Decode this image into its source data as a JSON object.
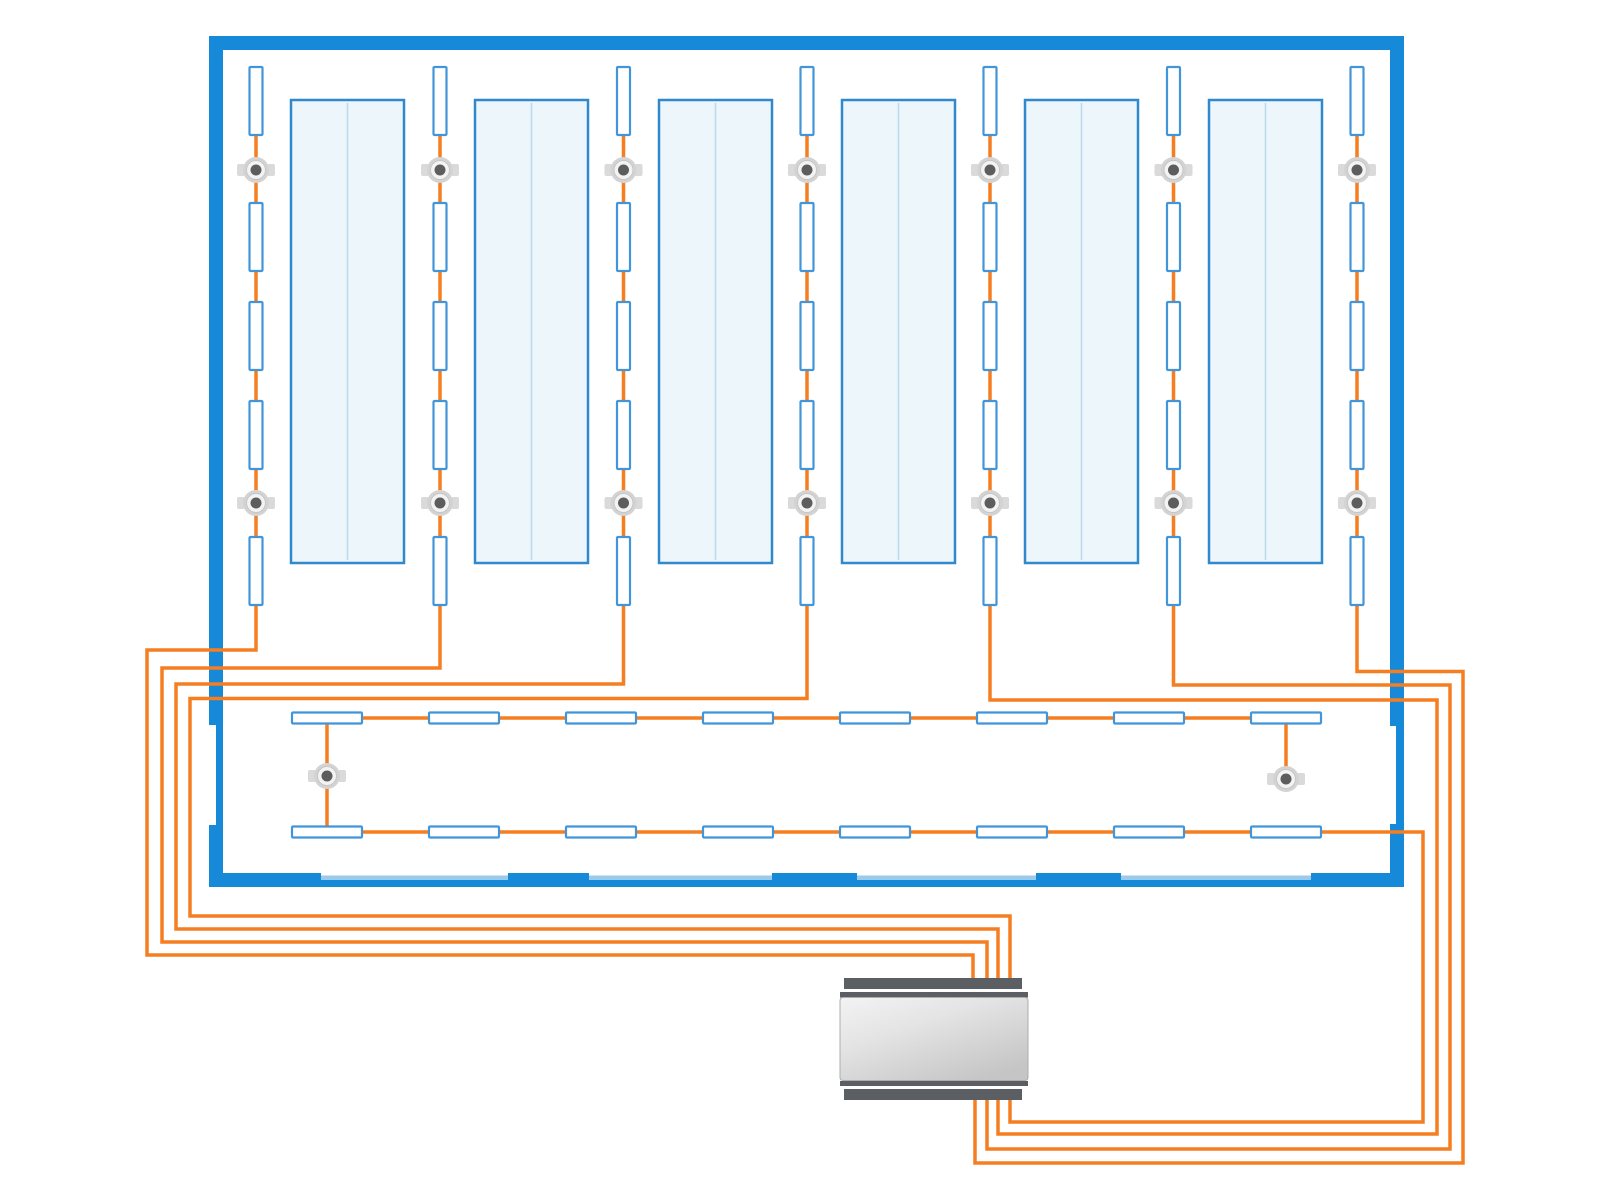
{
  "canvas": {
    "width": 1600,
    "height": 1200,
    "background": "#ffffff"
  },
  "palette": {
    "wall": "#1789d9",
    "wall_light": "#9ccaeb",
    "panel_border": "#3088cd",
    "panel_fill": "#edf6fb",
    "panel_line": "#bcd9ec",
    "fixture_border": "#4295d9",
    "fixture_fill": "#ffffff",
    "wire": "#f57e20",
    "sensor_tab": "#dadada",
    "sensor_ring": "#d3d3d3",
    "sensor_mid": "#f3f3f3",
    "sensor_dot": "#5d5d5d",
    "device_bar": "#5b5f63",
    "device_edge": "#adadad"
  },
  "room": {
    "walls": [
      {
        "x": 209,
        "y": 36,
        "w": 1195,
        "h": 14
      },
      {
        "x": 209,
        "y": 36,
        "w": 14,
        "h": 689
      },
      {
        "x": 216,
        "y": 725,
        "w": 7,
        "h": 100
      },
      {
        "x": 209,
        "y": 825,
        "w": 14,
        "h": 62
      },
      {
        "x": 1390,
        "y": 36,
        "w": 14,
        "h": 690
      },
      {
        "x": 1396,
        "y": 726,
        "w": 8,
        "h": 98
      },
      {
        "x": 1390,
        "y": 824,
        "w": 14,
        "h": 63
      },
      {
        "x": 209,
        "y": 880,
        "w": 1195,
        "h": 7
      }
    ],
    "bottom_glass": {
      "x": 223,
      "y": 875.5,
      "w": 1167,
      "h": 4.5
    },
    "bottom_blocks": {
      "y": 873,
      "h": 14,
      "xw": [
        [
          223,
          98
        ],
        [
          508,
          81
        ],
        [
          772,
          85
        ],
        [
          1036,
          85
        ],
        [
          1311,
          93
        ]
      ]
    }
  },
  "panels": {
    "y": 100,
    "w": 113,
    "h": 463,
    "lefts": [
      291,
      475,
      659,
      842,
      1025,
      1209
    ]
  },
  "columns": {
    "centers": [
      256,
      440,
      623.5,
      807,
      990,
      1173.5,
      1357
    ],
    "fixture": {
      "w": 13,
      "h": 68
    },
    "fixture_tops": [
      67,
      203,
      302,
      401,
      537
    ],
    "sensor_ys": [
      170,
      503
    ]
  },
  "corridor": {
    "fixture": {
      "w": 70,
      "h": 11
    },
    "centers": [
      327,
      464,
      601,
      738,
      875,
      1012,
      1149,
      1286
    ],
    "row_tops": [
      712.5,
      826.5
    ],
    "sensors": [
      [
        327,
        776
      ],
      [
        1286,
        779
      ]
    ]
  },
  "wires": [
    {
      "name": "circuit-column-1",
      "points": [
        [
          256,
          120
        ],
        [
          256,
          650
        ],
        [
          147,
          650
        ],
        [
          147,
          955
        ],
        [
          973,
          955
        ],
        [
          973,
          985
        ]
      ]
    },
    {
      "name": "circuit-column-2",
      "points": [
        [
          440,
          120
        ],
        [
          440,
          668
        ],
        [
          162,
          668
        ],
        [
          162,
          942
        ],
        [
          987,
          942
        ],
        [
          987,
          985
        ]
      ]
    },
    {
      "name": "circuit-column-3",
      "points": [
        [
          623.5,
          120
        ],
        [
          623.5,
          684
        ],
        [
          176,
          684
        ],
        [
          176,
          929
        ],
        [
          998,
          929
        ],
        [
          998,
          985
        ]
      ]
    },
    {
      "name": "circuit-column-4",
      "points": [
        [
          807,
          120
        ],
        [
          807,
          698.5
        ],
        [
          190,
          698.5
        ],
        [
          190,
          916
        ],
        [
          1010,
          916
        ],
        [
          1010,
          985
        ]
      ]
    },
    {
      "name": "circuit-column-5",
      "points": [
        [
          990,
          120
        ],
        [
          990,
          700
        ],
        [
          1437,
          700
        ],
        [
          1437,
          1134
        ],
        [
          998,
          1134
        ],
        [
          998,
          1095
        ]
      ]
    },
    {
      "name": "circuit-column-6",
      "points": [
        [
          1173.5,
          120
        ],
        [
          1173.5,
          685
        ],
        [
          1450,
          685
        ],
        [
          1450,
          1149
        ],
        [
          987,
          1149
        ],
        [
          987,
          1095
        ]
      ]
    },
    {
      "name": "circuit-column-7",
      "points": [
        [
          1357,
          120
        ],
        [
          1357,
          671.5
        ],
        [
          1463,
          671.5
        ],
        [
          1463,
          1163
        ],
        [
          975,
          1163
        ],
        [
          975,
          1095
        ]
      ]
    },
    {
      "name": "corridor-top-run",
      "points": [
        [
          327,
          718
        ],
        [
          1286,
          718
        ]
      ]
    },
    {
      "name": "corridor-left-link",
      "points": [
        [
          327,
          720
        ],
        [
          327,
          830
        ]
      ]
    },
    {
      "name": "corridor-right-link",
      "points": [
        [
          1286,
          722
        ],
        [
          1286,
          777
        ]
      ]
    },
    {
      "name": "corridor-return",
      "points": [
        [
          327,
          832
        ],
        [
          1423,
          832
        ],
        [
          1423,
          1122
        ],
        [
          1010,
          1122
        ],
        [
          1010,
          1095
        ]
      ]
    }
  ],
  "device": {
    "body": {
      "x": 840,
      "y": 997.5,
      "w": 188,
      "h": 83
    },
    "bars": [
      [
        844,
        978,
        178,
        11
      ],
      [
        844,
        1089,
        178,
        11
      ]
    ],
    "thins": [
      [
        840,
        992,
        188,
        5.5
      ],
      [
        840,
        1081,
        188,
        5
      ]
    ]
  }
}
